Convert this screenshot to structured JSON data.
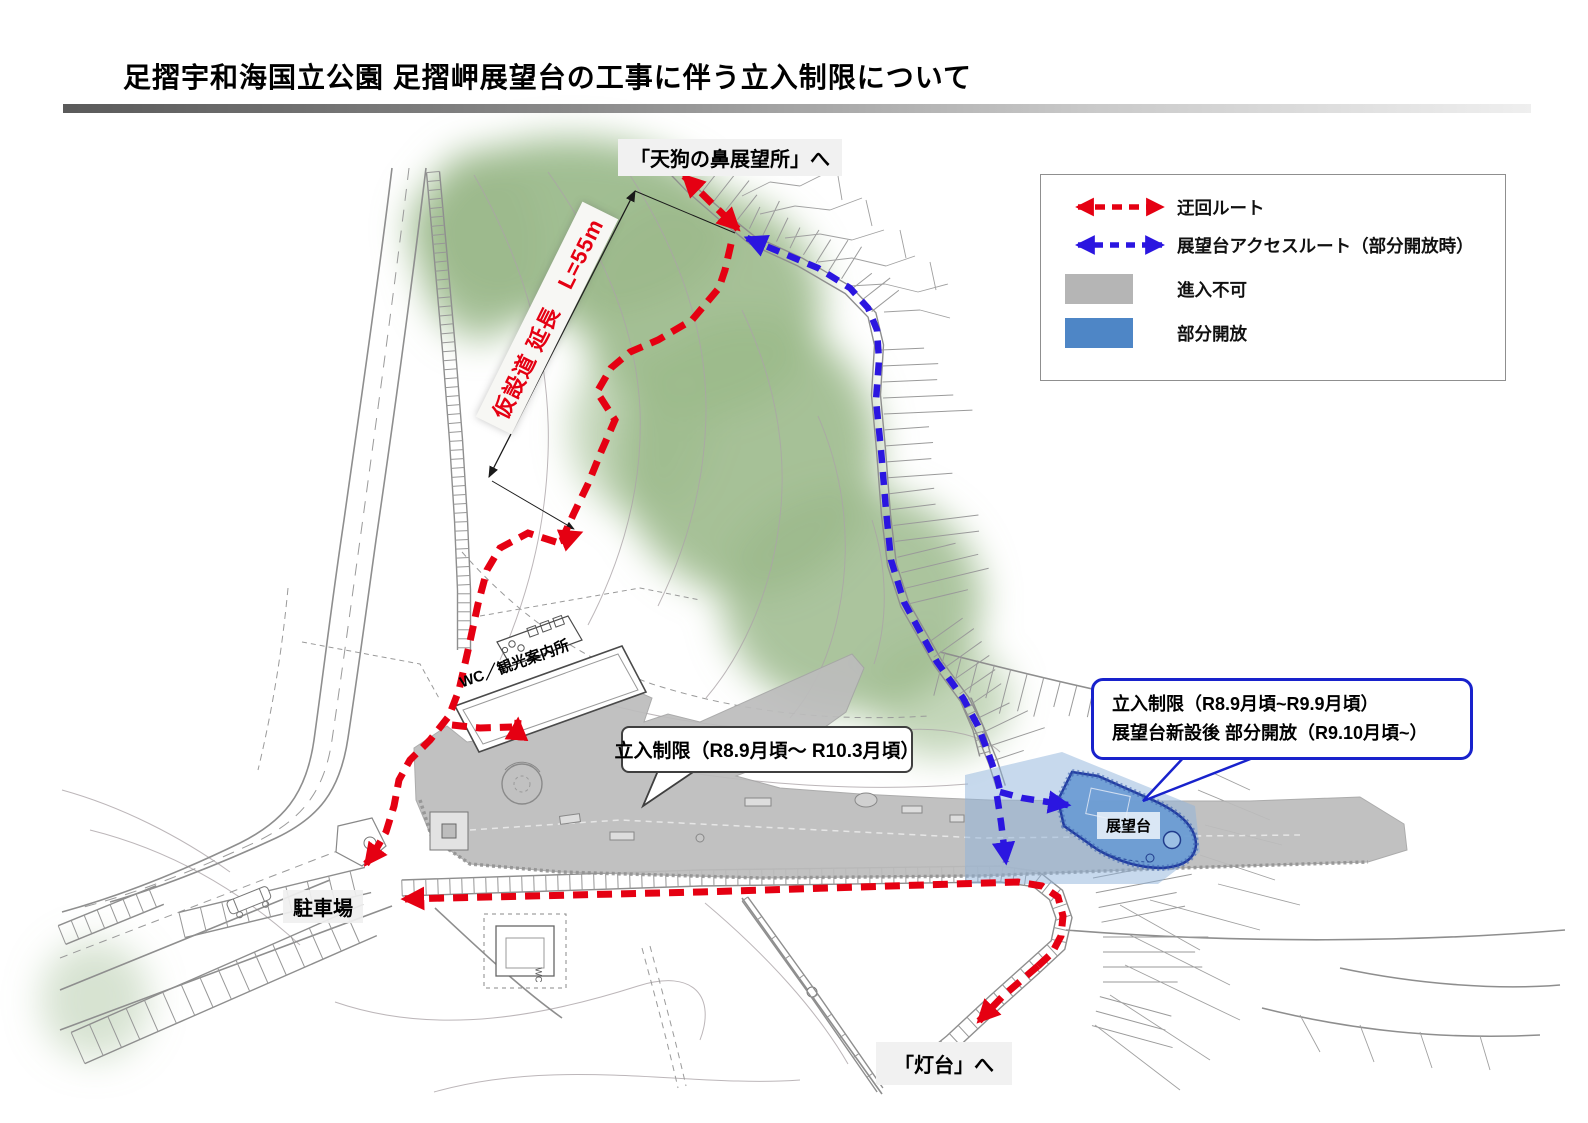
{
  "page": {
    "title": "足摺宇和海国立公園 足摺岬展望台の工事に伴う立入制限について"
  },
  "legend": {
    "items": [
      {
        "id": "detour",
        "label": "迂回ルート",
        "type": "arrow",
        "color": "#e50012"
      },
      {
        "id": "access",
        "label": "展望台アクセスルート（部分開放時）",
        "type": "arrow",
        "color": "#2b16e0"
      },
      {
        "id": "no-entry",
        "label": "進入不可",
        "type": "swatch",
        "color": "#b5b5b5"
      },
      {
        "id": "partial-open",
        "label": "部分開放",
        "type": "swatch",
        "color": "#4e86c6"
      }
    ]
  },
  "map": {
    "labels": {
      "tengu": "「天狗の鼻展望所」へ",
      "lighthouse": "「灯台」へ",
      "parking": "駐車場",
      "wc_info": "WC／観光案内所",
      "observatory": "展望台",
      "wc_small": "WC",
      "temp_road": "仮設道 延長　L=55m"
    },
    "callouts": {
      "restriction_main": "立入制限（R8.9月頃～ R10.3月頃）",
      "restriction_observatory_line1": "立入制限（R8.9月頃~R9.9月頃）",
      "restriction_observatory_line2": "展望台新設後 部分開放（R9.10月頃~）"
    },
    "colors": {
      "detour_route": "#e50012",
      "access_route": "#2b16e0",
      "no_entry": "#b5b5b5",
      "partial_open": "#4e86c6",
      "forest": "#9cba8c"
    }
  }
}
